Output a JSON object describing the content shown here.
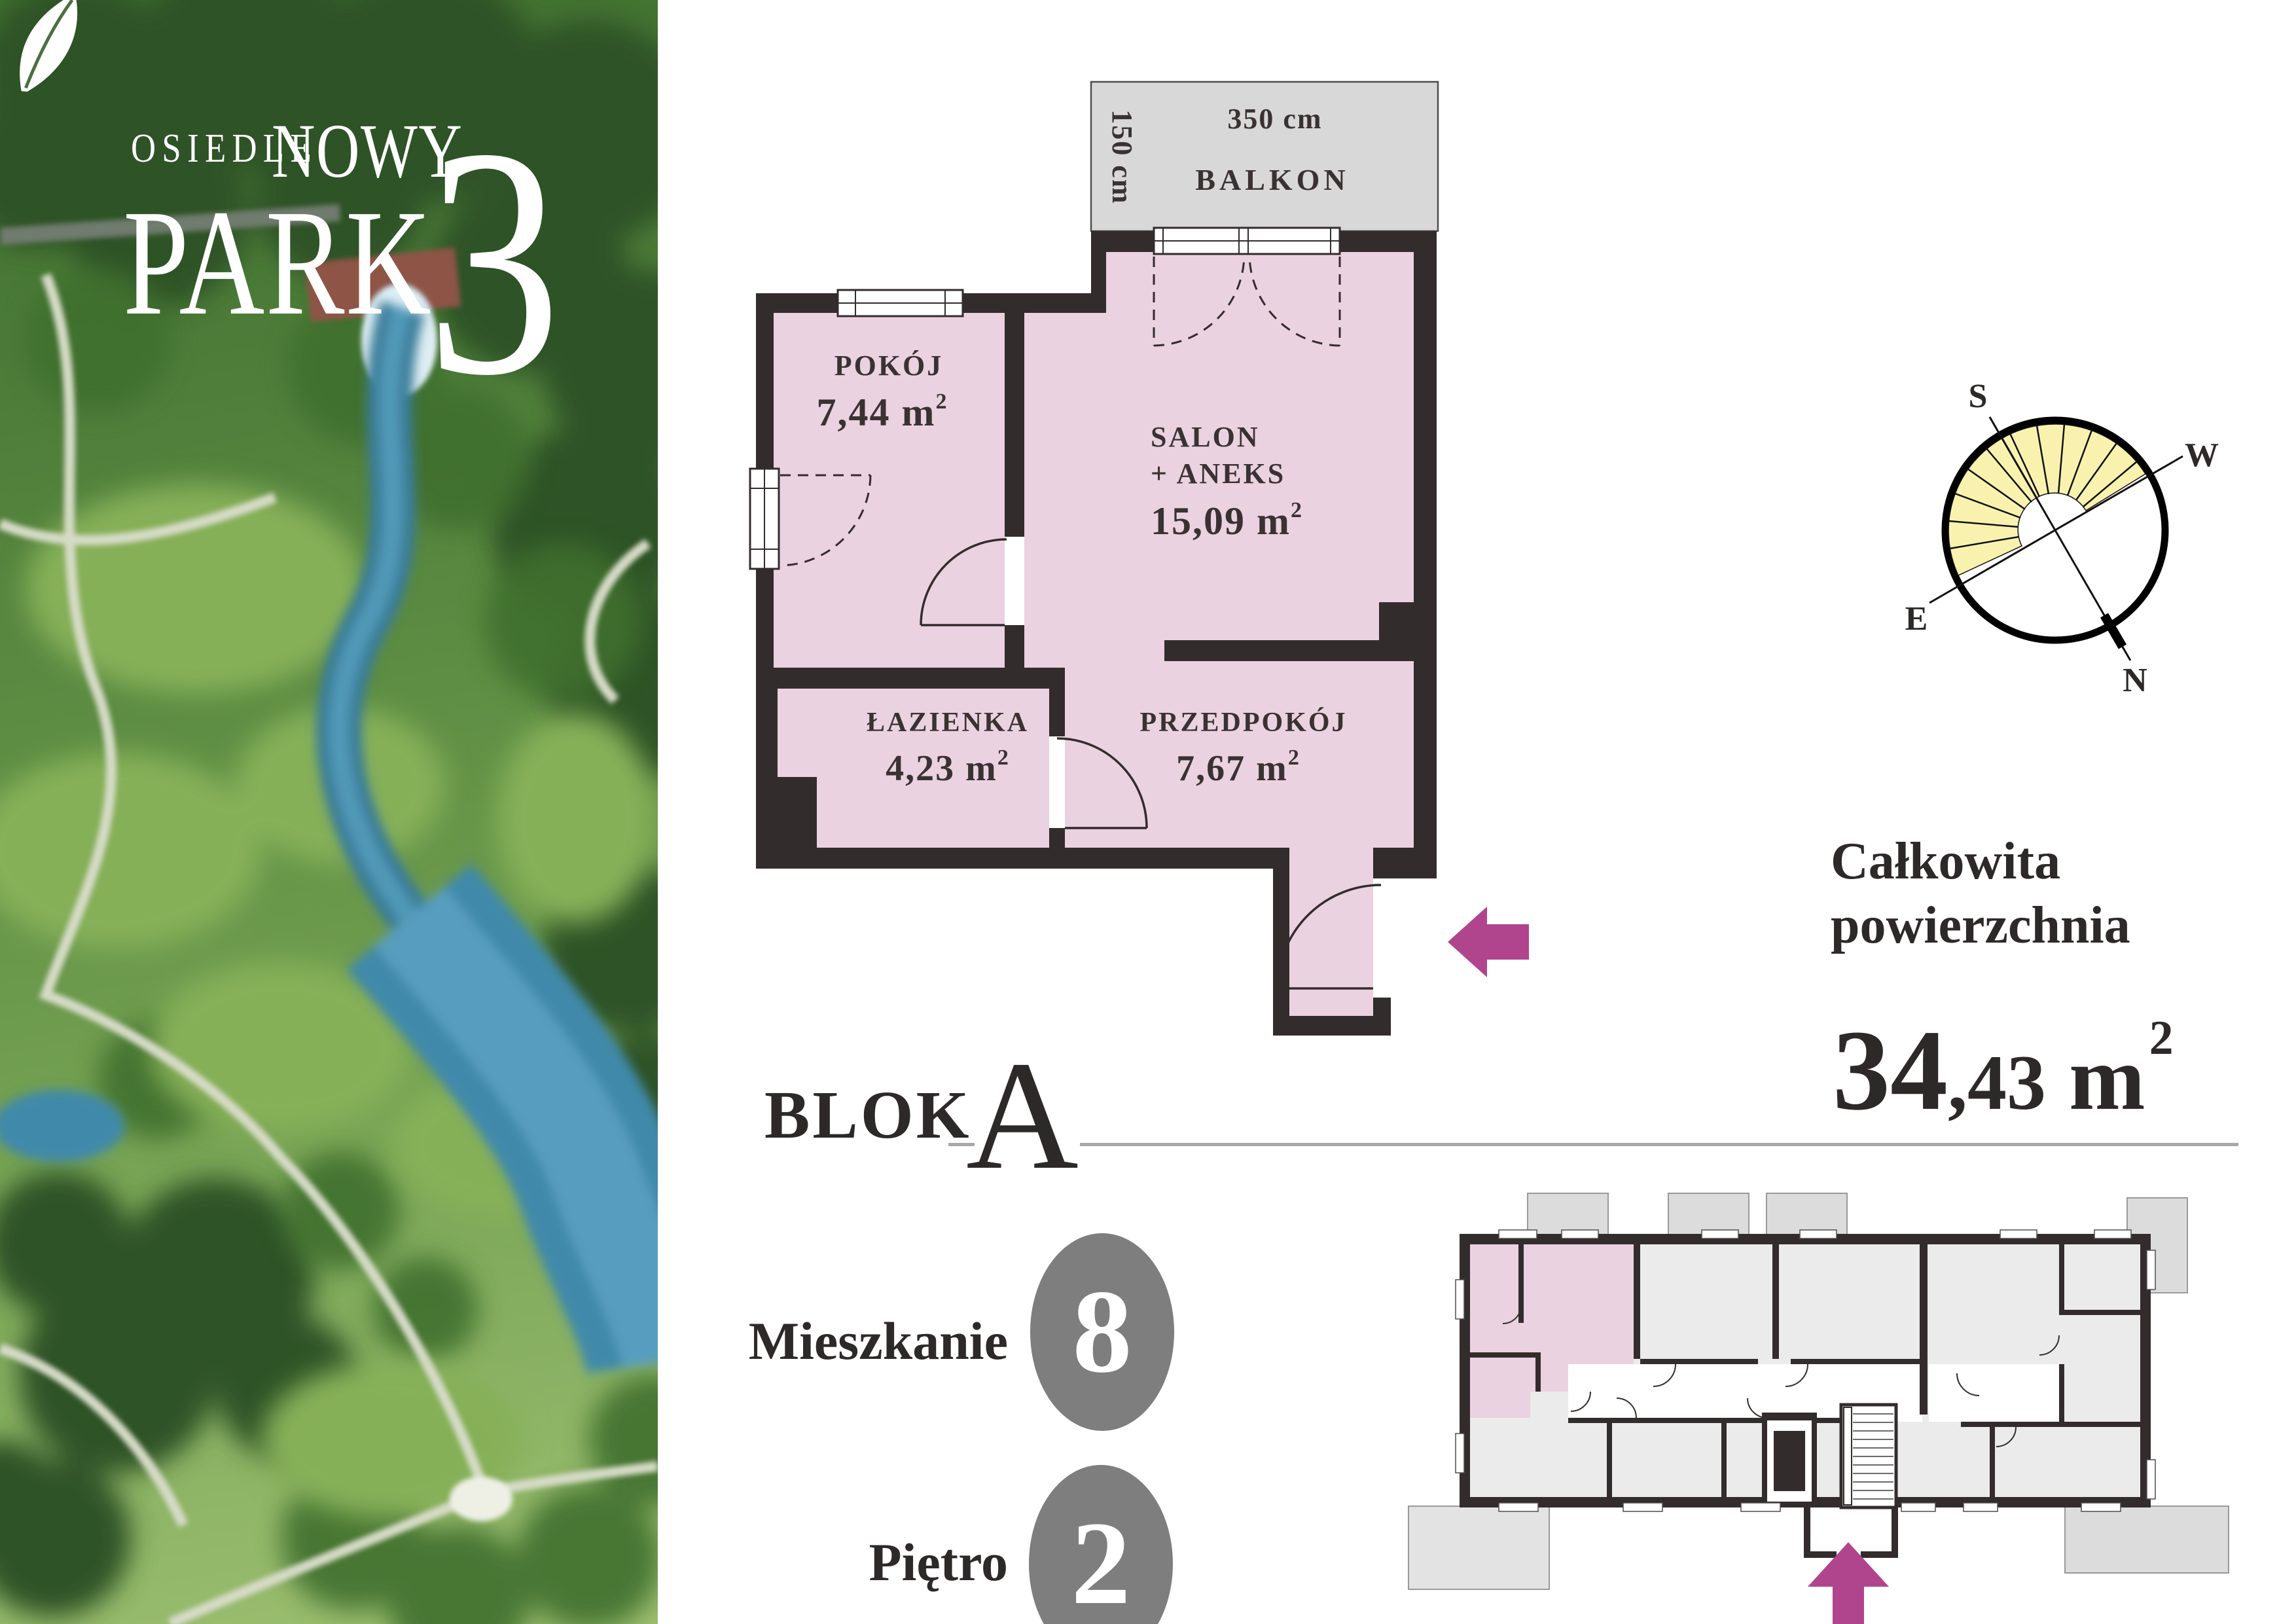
{
  "logo": {
    "prefix": "OSIEDLE",
    "name_top": "NOWY",
    "name_bottom": "PARK",
    "number": "3"
  },
  "floor_plan": {
    "balcony": {
      "label": "BALKON",
      "width": "350 cm",
      "depth": "150 cm"
    },
    "rooms": [
      {
        "name": "POKÓJ",
        "area": "7,44 m",
        "sup": "2"
      },
      {
        "name": "SALON",
        "name2": "+ ANEKS",
        "area": "15,09 m",
        "sup": "2"
      },
      {
        "name": "ŁAZIENKA",
        "area": "4,23 m",
        "sup": "2"
      },
      {
        "name": "PRZEDPOKÓJ",
        "area": "7,67 m",
        "sup": "2"
      }
    ]
  },
  "block": {
    "label": "BLOK",
    "value": "A"
  },
  "total_area": {
    "label_line1": "Całkowita",
    "label_line2": "powierzchnia",
    "value_int": "34",
    "value_dec": ",43",
    "unit": " m",
    "sup": "2"
  },
  "details": [
    {
      "label": "Mieszkanie",
      "value": "8"
    },
    {
      "label": "Piętro",
      "value": "2"
    }
  ],
  "compass": {
    "n": "N",
    "s": "S",
    "e": "E",
    "w": "W"
  },
  "colors": {
    "room_fill": "#ebd2e0",
    "wall": "#332c2c",
    "balcony_fill": "#d8d8d8",
    "accent_arrow": "#b0458e",
    "badge_gray": "#7e7e7e",
    "compass_yellow": "#f8f2ae",
    "building_fill": "#ebebeb",
    "rule_gray": "#a8a8a8"
  }
}
